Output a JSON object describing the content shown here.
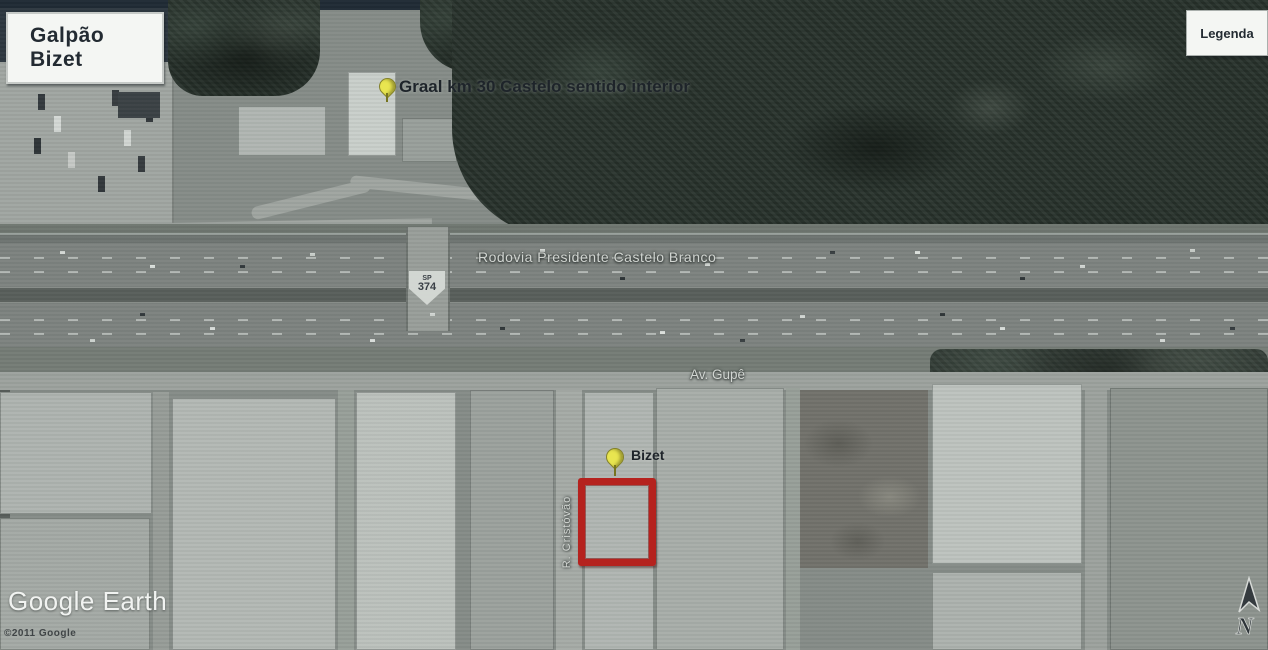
{
  "window": {
    "title_box": "Galpão Bizet",
    "legend_box": "Legenda",
    "watermark": "Google Earth",
    "copyright": "©2011 Google"
  },
  "pins": [
    {
      "id": "graal",
      "label": "Graal km 30 Castelo sentido interior",
      "icon": "yellow-pushpin"
    },
    {
      "id": "bizet",
      "label": "Bizet",
      "icon": "yellow-pushpin"
    }
  ],
  "roads": {
    "highway_name": "Rodovia Presidente Castelo Branco",
    "shield_state": "SP",
    "shield_number": "374",
    "avenue_name": "Av. Gupê",
    "street_name": "R. Cristóvão"
  },
  "compass": {
    "north_label": "N",
    "icon": "north-arrow"
  },
  "annotations": {
    "highlight_shape": "red-rectangle-property-outline"
  },
  "colors": {
    "highlight_red": "#b5221e",
    "pushpin_yellow": "#e8e550",
    "panel_bg": "#f4f6f3",
    "forest_green": "#242d27"
  }
}
